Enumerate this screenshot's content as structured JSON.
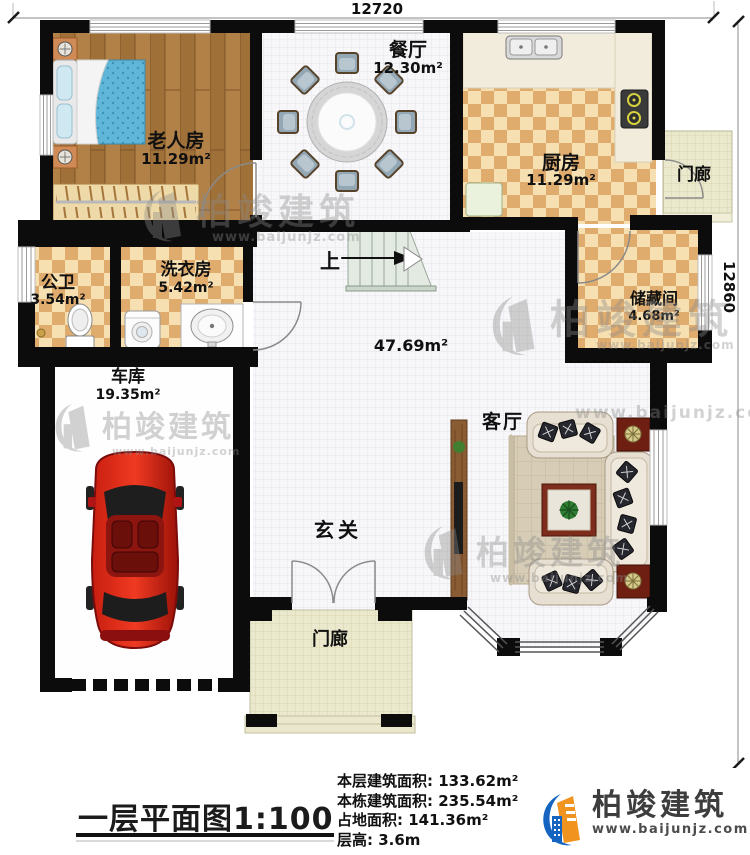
{
  "dimensions": {
    "top": "12720",
    "right": "12860"
  },
  "rooms": {
    "dining": {
      "name": "餐厅",
      "area": "12.30m²"
    },
    "elderly": {
      "name": "老人房",
      "area": "11.29m²"
    },
    "kitchen": {
      "name": "厨房",
      "area": "11.29m²"
    },
    "porch_top": {
      "name": "门廊"
    },
    "bath": {
      "name": "公卫",
      "area": "3.54m²"
    },
    "laundry": {
      "name": "洗衣房",
      "area": "5.42m²"
    },
    "storage": {
      "name": "储藏间",
      "area": "4.68m²"
    },
    "garage": {
      "name": "车库",
      "area": "19.35m²"
    },
    "hall": {
      "area": "47.69m²",
      "stairs_label": "上"
    },
    "foyer": {
      "name": "玄关"
    },
    "living": {
      "name": "客厅"
    },
    "porch_bottom": {
      "name": "门廊"
    }
  },
  "watermark": {
    "brand": "柏竣建筑",
    "site": "www.baijunjz.com"
  },
  "footer": {
    "title": "一层平面图1:100",
    "stats": [
      "本层建筑面积: 133.62m²",
      "本栋建筑面积: 235.54m²",
      "占地面积: 141.36m²",
      "层高: 3.6m"
    ],
    "brand": {
      "name": "柏竣建筑",
      "site": "www.baijunjz.com"
    }
  }
}
